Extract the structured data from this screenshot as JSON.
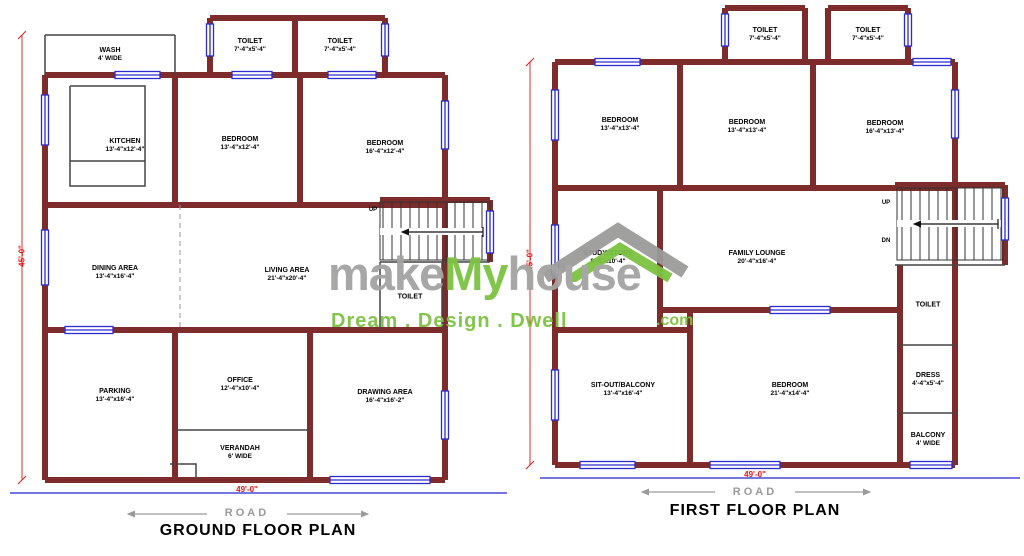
{
  "colors": {
    "wall_maroon": "#7d2b2b",
    "window_blue": "#2b2bcf",
    "dimension_red": "#e81111",
    "road_line_blue": "#2323cc",
    "road_text_gray": "#9a9a9a",
    "watermark_gray": "#a3a3a2",
    "watermark_green": "#7cc242"
  },
  "watermark": {
    "word1": "make",
    "word2": "My",
    "word3": "house",
    "tld": ".com",
    "tagline": "Dream . Design . Dwell"
  },
  "ground_floor": {
    "title": "GROUND FLOOR PLAN",
    "road_label": "ROAD",
    "width_dim": "49'-0\"",
    "height_dim": "45'-0\"",
    "stair_up": "UP",
    "rooms": [
      {
        "name": "WASH",
        "dims": "4' WIDE"
      },
      {
        "name": "TOILET",
        "dims": "7'-4\"x5'-4\""
      },
      {
        "name": "TOILET",
        "dims": "7'-4\"x5'-4\""
      },
      {
        "name": "KITCHEN",
        "dims": "13'-4\"x12'-4\""
      },
      {
        "name": "BEDROOM",
        "dims": "13'-4\"x12'-4\""
      },
      {
        "name": "BEDROOM",
        "dims": "16'-4\"x12'-4\""
      },
      {
        "name": "DINING AREA",
        "dims": "13'-4\"x16'-4\""
      },
      {
        "name": "LIVING AREA",
        "dims": "21'-4\"x20'-4\""
      },
      {
        "name": "TOILET",
        "dims": ""
      },
      {
        "name": "PARKING",
        "dims": "13'-4\"x16'-4\""
      },
      {
        "name": "OFFICE",
        "dims": "12'-4\"x10'-4\""
      },
      {
        "name": "DRAWING AREA",
        "dims": "16'-4\"x16'-2\""
      },
      {
        "name": "VERANDAH",
        "dims": "6' WIDE"
      }
    ]
  },
  "first_floor": {
    "title": "FIRST FLOOR PLAN",
    "road_label": "ROAD",
    "width_dim": "49'-0\"",
    "height_dim": "45'-0\"",
    "stair_up": "UP",
    "stair_dn": "DN",
    "rooms": [
      {
        "name": "TOILET",
        "dims": "7'-4\"x5'-4\""
      },
      {
        "name": "TOILET",
        "dims": "7'-4\"x5'-4\""
      },
      {
        "name": "BEDROOM",
        "dims": "13'-4\"x13'-4\""
      },
      {
        "name": "BEDROOM",
        "dims": "13'-4\"x13'-4\""
      },
      {
        "name": "BEDROOM",
        "dims": "16'-4\"x13'-4\""
      },
      {
        "name": "STUDY/STORE",
        "dims": "8'-4\"x10'-4\""
      },
      {
        "name": "FAMILY LOUNGE",
        "dims": "20'-4\"x16'-4\""
      },
      {
        "name": "TOILET",
        "dims": ""
      },
      {
        "name": "SIT-OUT/BALCONY",
        "dims": "13'-4\"x16'-4\""
      },
      {
        "name": "BEDROOM",
        "dims": "21'-4\"x14'-4\""
      },
      {
        "name": "DRESS",
        "dims": "4'-4\"x5'-4\""
      },
      {
        "name": "BALCONY",
        "dims": "4' WIDE"
      }
    ]
  }
}
